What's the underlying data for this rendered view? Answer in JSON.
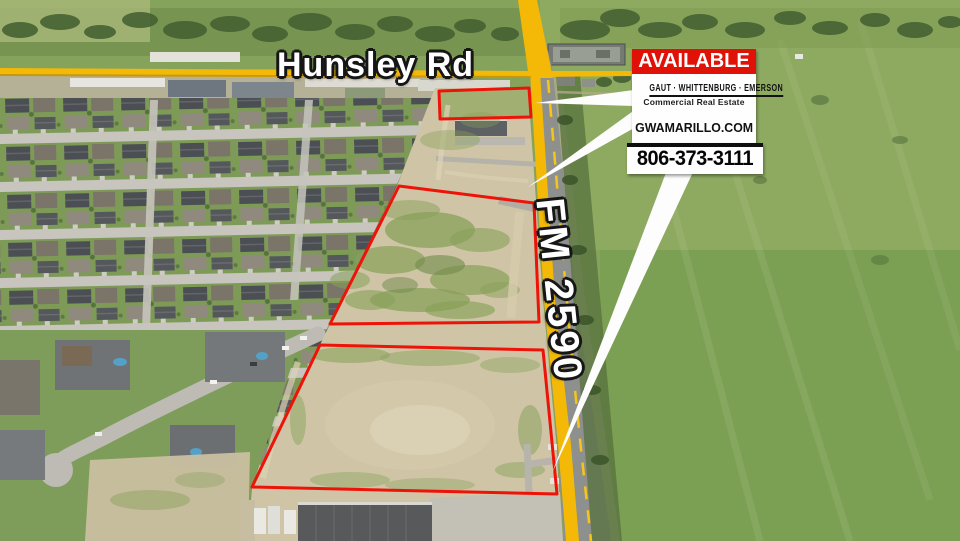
{
  "labels": {
    "cross_street": "Hunsley Rd",
    "highway": "FM 2590"
  },
  "sign": {
    "banner": "AVAILABLE",
    "brokerage": "GAUT · WHITTENBURG · EMERSON",
    "tagline": "Commercial Real Estate",
    "website": "GWAMARILLO.COM",
    "phone": "806-373-3111"
  },
  "colors": {
    "parcel_red": "#ee1309",
    "road_yellow": "#f4b906",
    "sign_banner_red": "#e01207"
  },
  "overlay": {
    "parcels": [
      {
        "points": "439,91 529,88 531,117 440,119"
      },
      {
        "points": "399,186 534,203 539,322 330,324"
      },
      {
        "points": "320,345 543,350 557,494 252,487"
      }
    ],
    "leaders": [
      {
        "points": "634,90 634,106 535,103"
      },
      {
        "points": "636,109 636,127 528,187"
      },
      {
        "points": "667,170 694,170 552,473"
      }
    ]
  }
}
